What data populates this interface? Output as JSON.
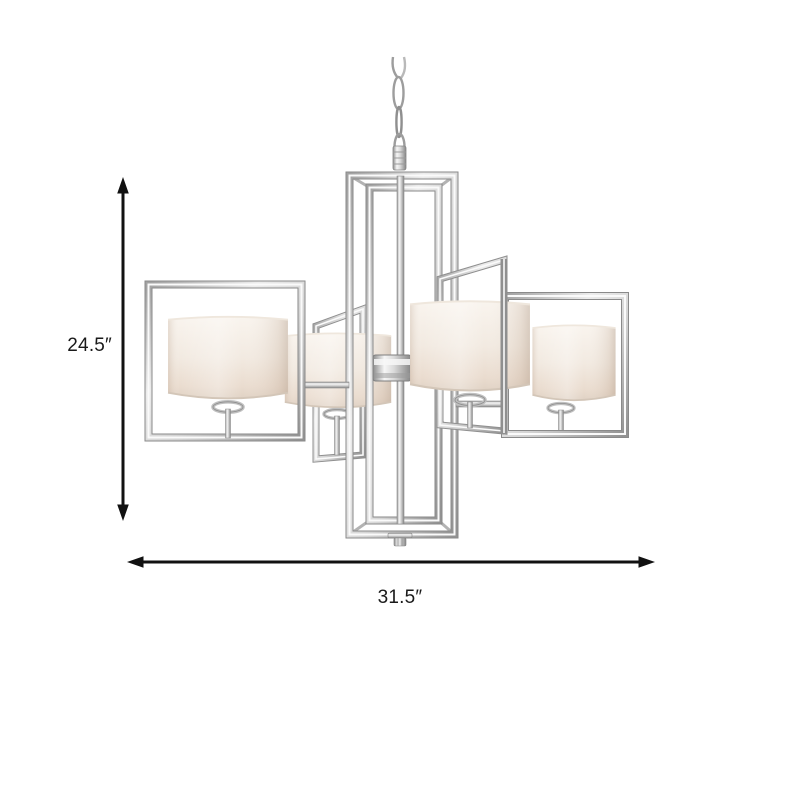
{
  "figure": {
    "kind": "product-dimension-diagram",
    "subject": "Four-light polished chrome chandelier with rectangular open frames, white fabric drum shades and hanging chain",
    "background_color": "#ffffff"
  },
  "dimensions": {
    "height": {
      "label": "24.5″",
      "orientation": "vertical"
    },
    "width": {
      "label": "31.5″",
      "orientation": "horizontal"
    }
  },
  "colors": {
    "arrow": "#111111",
    "label_text": "#1a1a1a",
    "chrome_highlight": "#f7f7f7",
    "chrome_mid": "#c9c9c9",
    "chrome_shadow": "#868686",
    "shade_top": "#f9f4ee",
    "shade_bottom": "#e0d2c4"
  }
}
